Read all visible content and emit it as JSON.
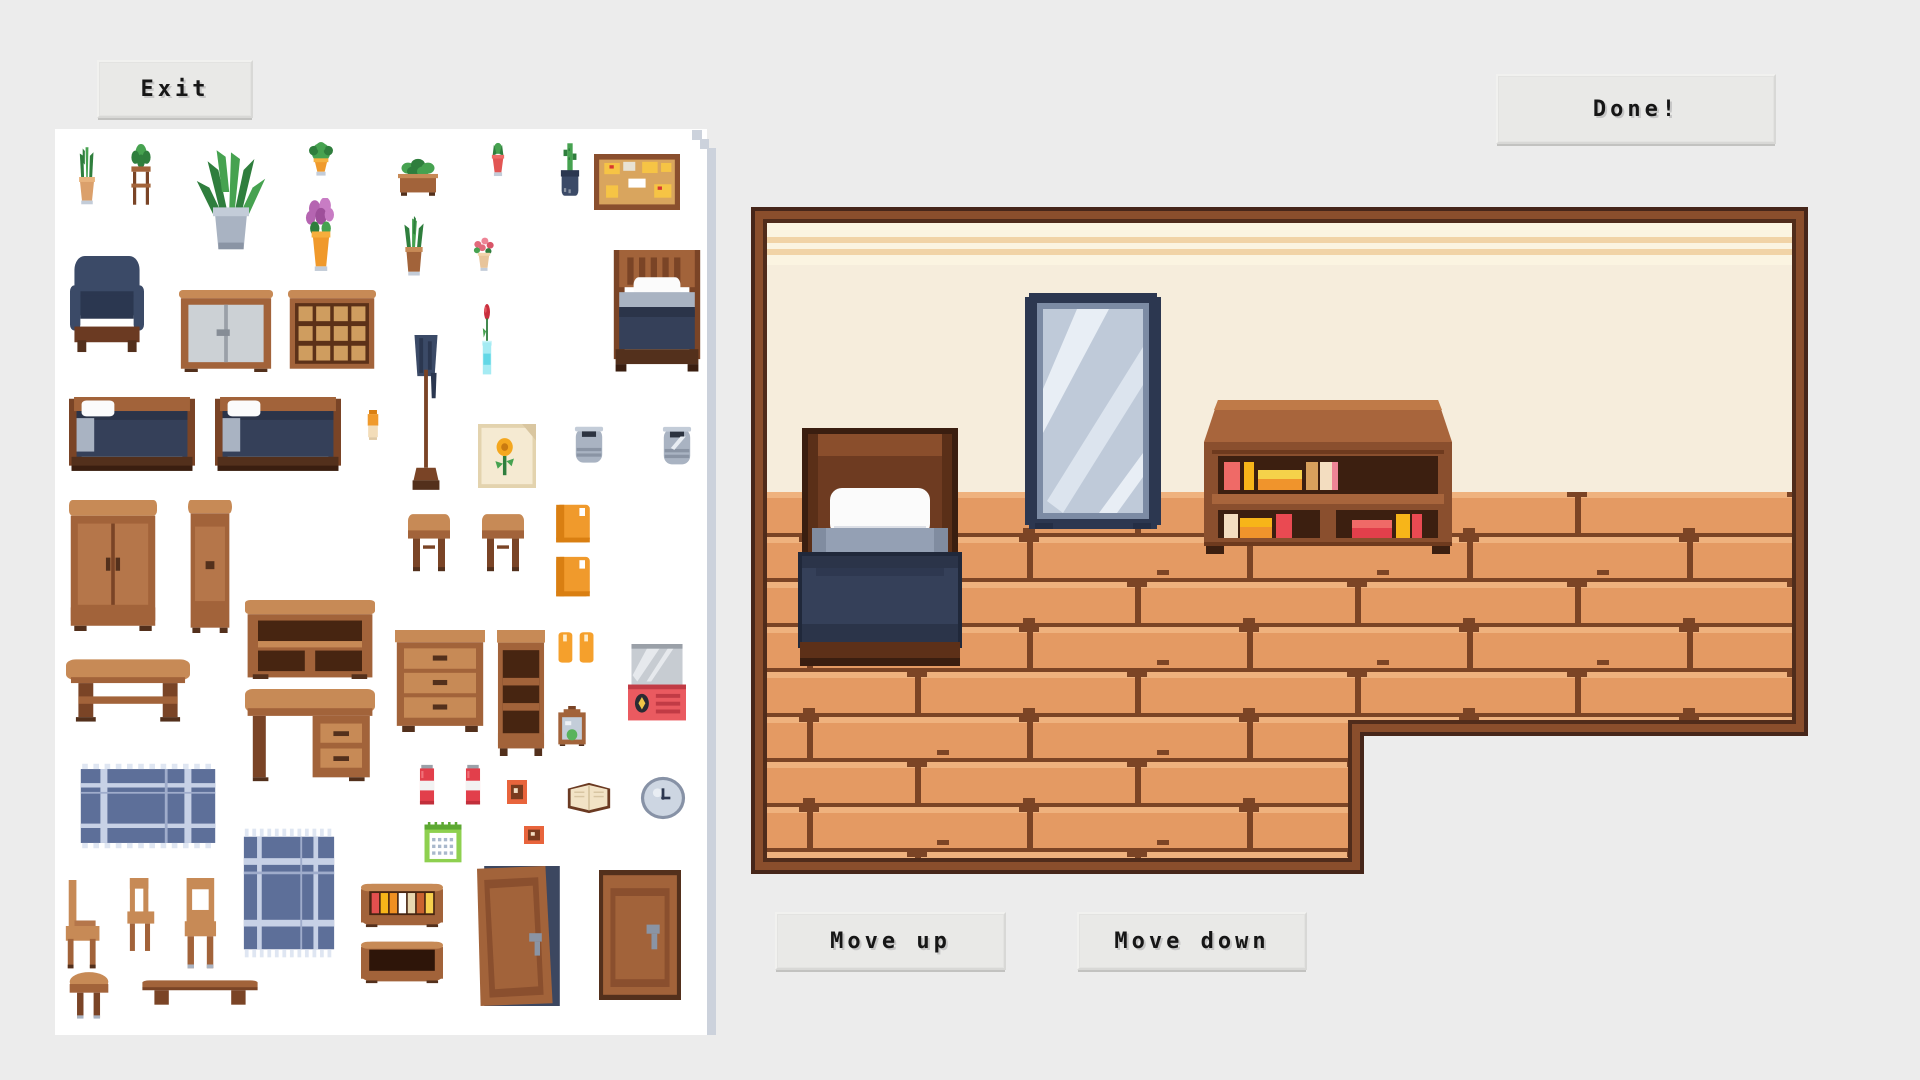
{
  "header": {
    "exit_label": "Exit",
    "done_label": "Done!"
  },
  "footer": {
    "move_up_label": "Move up",
    "move_down_label": "Move down"
  },
  "palette": {
    "page_bg": "#ececec",
    "panel_bg": "#ffffff",
    "panel_shadow": "#ccd2dc",
    "button_bg": "#e9e9e7",
    "button_text": "#161616",
    "wood": "#a2633a",
    "wood_light": "#c78a56",
    "wood_dark": "#7a4426",
    "wood_darkest": "#53301c",
    "navy": "#3b4a67",
    "navy_dark": "#2b3750",
    "leaf_green": "#46a250",
    "leaf_green_dark": "#2f7e3d",
    "room_border_outer": "#46261a",
    "room_border_mid": "#8a4e2c",
    "room_border_inner": "#502c1b",
    "wall": "#f6eddc",
    "wall_band": "#fbf4e1",
    "wall_stripe": "#f1d3a6",
    "floor": "#e49a63",
    "floor_highlight": "#efb27e",
    "floor_seam": "#7b4425"
  },
  "catalog": {
    "items": [
      {
        "name": "snake-plant",
        "type": "plant_snake",
        "x": 69,
        "y": 146,
        "w": 36,
        "h": 62
      },
      {
        "name": "plant-on-stand",
        "type": "plant_stand",
        "x": 121,
        "y": 144,
        "w": 40,
        "h": 66
      },
      {
        "name": "large-palm",
        "type": "plant_large",
        "x": 186,
        "y": 148,
        "w": 90,
        "h": 110
      },
      {
        "name": "potted-fern",
        "type": "plant_hang",
        "x": 298,
        "y": 142,
        "w": 46,
        "h": 48
      },
      {
        "name": "planter-box",
        "type": "plant_planter",
        "x": 393,
        "y": 158,
        "w": 50,
        "h": 42
      },
      {
        "name": "red-potted-plant",
        "type": "plant_red",
        "x": 481,
        "y": 142,
        "w": 34,
        "h": 46
      },
      {
        "name": "cactus-dark-pot",
        "type": "plant_dark",
        "x": 551,
        "y": 142,
        "w": 38,
        "h": 64
      },
      {
        "name": "corkboard",
        "type": "corkboard",
        "x": 594,
        "y": 154,
        "w": 86,
        "h": 56
      },
      {
        "name": "purple-flowers",
        "type": "flower_purple",
        "x": 295,
        "y": 198,
        "w": 52,
        "h": 76
      },
      {
        "name": "green-plant",
        "type": "plant_green",
        "x": 390,
        "y": 216,
        "w": 48,
        "h": 62
      },
      {
        "name": "pink-flowers",
        "type": "flower_pink",
        "x": 462,
        "y": 236,
        "w": 44,
        "h": 42
      },
      {
        "name": "armchair",
        "type": "armchair",
        "x": 70,
        "y": 256,
        "w": 74,
        "h": 98
      },
      {
        "name": "white-cabinet",
        "type": "cabinet_white",
        "x": 179,
        "y": 290,
        "w": 94,
        "h": 82
      },
      {
        "name": "display-cabinet",
        "type": "shelf_glass",
        "x": 288,
        "y": 290,
        "w": 88,
        "h": 82
      },
      {
        "name": "rose-in-vase",
        "type": "rose_vase",
        "x": 472,
        "y": 304,
        "w": 30,
        "h": 80
      },
      {
        "name": "single-bed",
        "type": "bed_single",
        "x": 612,
        "y": 250,
        "w": 90,
        "h": 124
      },
      {
        "name": "double-bed",
        "type": "bed_double",
        "x": 69,
        "y": 397,
        "w": 126,
        "h": 88
      },
      {
        "name": "double-bed-2",
        "type": "bed_double",
        "x": 215,
        "y": 397,
        "w": 126,
        "h": 88
      },
      {
        "name": "small-jar",
        "type": "jar",
        "x": 362,
        "y": 410,
        "w": 22,
        "h": 34
      },
      {
        "name": "coat-rack",
        "type": "coat_rack",
        "x": 402,
        "y": 335,
        "w": 48,
        "h": 158
      },
      {
        "name": "sunflower-painting",
        "type": "painting",
        "x": 478,
        "y": 424,
        "w": 58,
        "h": 64
      },
      {
        "name": "stone-pot",
        "type": "pot_gray",
        "x": 567,
        "y": 424,
        "w": 44,
        "h": 46
      },
      {
        "name": "stone-pot-2",
        "type": "pot_gray2",
        "x": 655,
        "y": 424,
        "w": 44,
        "h": 48
      },
      {
        "name": "wardrobe",
        "type": "wardrobe",
        "x": 69,
        "y": 500,
        "w": 88,
        "h": 131
      },
      {
        "name": "tall-cabinet",
        "type": "cabinet_tall",
        "x": 188,
        "y": 500,
        "w": 44,
        "h": 133
      },
      {
        "name": "end-table",
        "type": "stool_sq",
        "x": 404,
        "y": 510,
        "w": 50,
        "h": 68
      },
      {
        "name": "end-table-2",
        "type": "stool_sq",
        "x": 478,
        "y": 510,
        "w": 50,
        "h": 68
      },
      {
        "name": "orange-book",
        "type": "book_orange",
        "x": 553,
        "y": 504,
        "w": 40,
        "h": 40
      },
      {
        "name": "orange-book-2",
        "type": "book_orange",
        "x": 553,
        "y": 556,
        "w": 40,
        "h": 42
      },
      {
        "name": "console-shelf",
        "type": "console",
        "x": 245,
        "y": 600,
        "w": 130,
        "h": 79
      },
      {
        "name": "coffee-table",
        "type": "coffee_table",
        "x": 66,
        "y": 652,
        "w": 124,
        "h": 74
      },
      {
        "name": "desk",
        "type": "desk",
        "x": 245,
        "y": 689,
        "w": 130,
        "h": 96
      },
      {
        "name": "dresser",
        "type": "dresser3",
        "x": 395,
        "y": 630,
        "w": 90,
        "h": 102
      },
      {
        "name": "bookcase",
        "type": "bookcase",
        "x": 497,
        "y": 630,
        "w": 48,
        "h": 126
      },
      {
        "name": "candle-pair",
        "type": "candles",
        "x": 553,
        "y": 630,
        "w": 46,
        "h": 38
      },
      {
        "name": "tv-set",
        "type": "tv",
        "x": 628,
        "y": 644,
        "w": 58,
        "h": 78
      },
      {
        "name": "terrarium",
        "type": "terrarium",
        "x": 553,
        "y": 706,
        "w": 38,
        "h": 40
      },
      {
        "name": "plaid-rug",
        "type": "rug",
        "x": 78,
        "y": 762,
        "w": 140,
        "h": 88
      },
      {
        "name": "soda-can",
        "type": "soda",
        "x": 416,
        "y": 764,
        "w": 22,
        "h": 44
      },
      {
        "name": "soda-can-2",
        "type": "soda",
        "x": 462,
        "y": 764,
        "w": 22,
        "h": 44
      },
      {
        "name": "small-picture",
        "type": "pic_small",
        "x": 507,
        "y": 780,
        "w": 20,
        "h": 24
      },
      {
        "name": "open-book",
        "type": "book_open",
        "x": 566,
        "y": 780,
        "w": 46,
        "h": 36
      },
      {
        "name": "wall-clock",
        "type": "clock",
        "x": 640,
        "y": 776,
        "w": 46,
        "h": 44
      },
      {
        "name": "calendar",
        "type": "calendar",
        "x": 422,
        "y": 822,
        "w": 42,
        "h": 42
      },
      {
        "name": "small-picture-2",
        "type": "pic_small",
        "x": 524,
        "y": 826,
        "w": 20,
        "h": 18
      },
      {
        "name": "blue-rug",
        "type": "rug",
        "x": 242,
        "y": 826,
        "w": 94,
        "h": 134
      },
      {
        "name": "wooden-chair",
        "type": "chair",
        "x": 62,
        "y": 880,
        "w": 48,
        "h": 92
      },
      {
        "name": "wooden-chair-2",
        "type": "chair_b",
        "x": 124,
        "y": 878,
        "w": 42,
        "h": 76
      },
      {
        "name": "wooden-chair-3",
        "type": "chair_c",
        "x": 182,
        "y": 878,
        "w": 46,
        "h": 94
      },
      {
        "name": "book-shelf-small",
        "type": "shelf_books",
        "x": 361,
        "y": 882,
        "w": 82,
        "h": 46
      },
      {
        "name": "empty-shelf",
        "type": "shelf_empty",
        "x": 361,
        "y": 940,
        "w": 82,
        "h": 44
      },
      {
        "name": "open-door",
        "type": "door_open",
        "x": 477,
        "y": 866,
        "w": 90,
        "h": 140
      },
      {
        "name": "closed-door",
        "type": "door_closed",
        "x": 599,
        "y": 870,
        "w": 82,
        "h": 130
      },
      {
        "name": "round-stool",
        "type": "stool_round",
        "x": 66,
        "y": 970,
        "w": 46,
        "h": 54
      },
      {
        "name": "low-bench",
        "type": "bench",
        "x": 140,
        "y": 972,
        "w": 120,
        "h": 38
      }
    ]
  },
  "room": {
    "x": 751,
    "y": 207,
    "w": 1057,
    "h": 667,
    "notch_x": 613,
    "notch_y": 529,
    "wall_floor_y": 285,
    "furniture": [
      {
        "name": "single-bed",
        "kind": "bed",
        "x": 47,
        "y": 221,
        "w": 164,
        "h": 243
      },
      {
        "name": "standing-mirror",
        "kind": "mirror",
        "x": 274,
        "y": 86,
        "w": 136,
        "h": 236
      },
      {
        "name": "bookshelf",
        "kind": "shelf",
        "x": 453,
        "y": 193,
        "w": 248,
        "h": 151
      }
    ]
  }
}
